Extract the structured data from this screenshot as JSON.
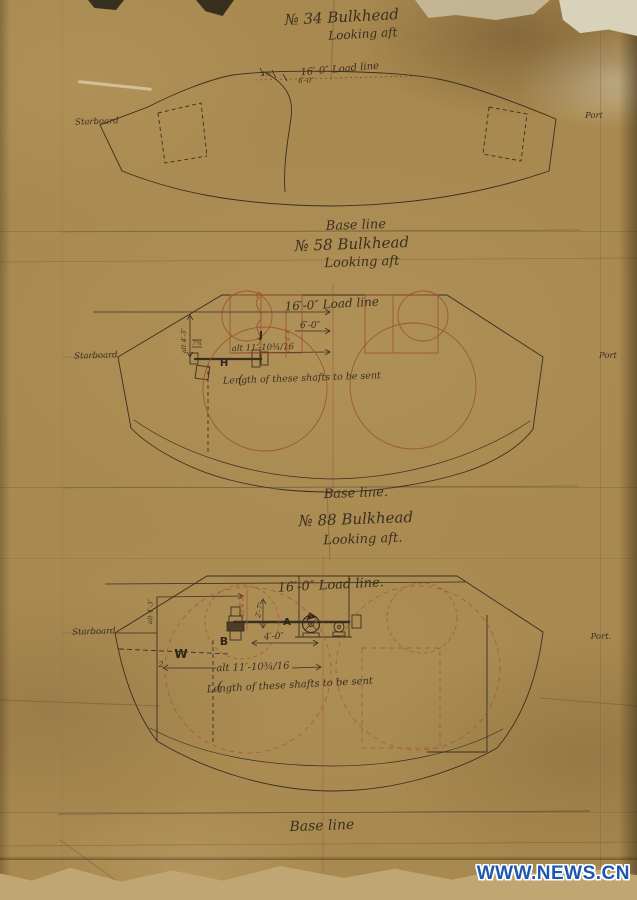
{
  "photo": {
    "watermark": "WWW.NEWS.CN",
    "colors": {
      "paper": "#a8894f",
      "ink": "#3b2f22",
      "construction_red": "#9c4f2e",
      "watermark_blue": "#1c57b0"
    }
  },
  "sections": [
    {
      "number_label": "№ 34 Bulkhead",
      "view_label": "Looking aft",
      "load_line_label": "16′-0″ Load line",
      "dim_small_a": "2½",
      "dim_small_b": "6′-0″",
      "starboard_label": "Starboard",
      "port_label": "Port",
      "base_line_label": "Base line"
    },
    {
      "number_label": "№ 58 Bulkhead",
      "view_label": "Looking aft",
      "load_line_label": "16′-0″ Load line",
      "dim_6ft": "6′-0″",
      "dim_alt_11": "alt 11′-10¾/16",
      "dim_alt_4_6": "alt 4′-6″",
      "dim_alt_4_3": "alt 4′-3″",
      "dim_7q": "7¼",
      "label_j": "J",
      "label_h": "H",
      "shaft_note": "Length of these shafts to be sent",
      "brace": "(",
      "starboard_label": "Starboard",
      "port_label": "Port",
      "base_line_label": "Base line."
    },
    {
      "number_label": "№ 88 Bulkhead",
      "view_label": "Looking aft.",
      "load_line_label": "16′-0″ Load line.",
      "dim_4ft": "4′-0″",
      "dim_2_7": "2′-7″",
      "dim_alt_11": "alt 11′-10¾/16",
      "dim_alt_4_6": "alt 4′-6″",
      "dim_alt_4_3": "alt 4′-3″",
      "dim_2": "2",
      "label_a": "A",
      "label_b": "B",
      "label_w": "W",
      "shaft_note": "Length of these shafts to be sent",
      "brace": "(",
      "starboard_label": "Starboard",
      "port_label": "Port.",
      "base_line_label": "Base line"
    }
  ]
}
